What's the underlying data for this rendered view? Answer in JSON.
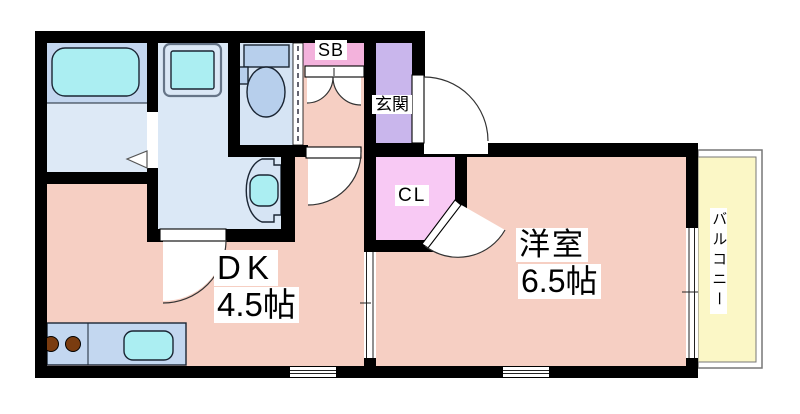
{
  "floorplan": {
    "rooms": {
      "dk": {
        "name": "DK",
        "size": "4.5帖"
      },
      "western_room": {
        "name": "洋室",
        "size": "6.5帖"
      },
      "entrance": {
        "name": "玄関"
      },
      "closet": {
        "name": "CL"
      },
      "shoe_box": {
        "name": "SB"
      },
      "balcony": {
        "name": "バルコニー"
      }
    },
    "colors": {
      "wall": "#000000",
      "floor_main": "#f6cfc3",
      "floor_bath": "#dde9f6",
      "tub_area": "#c3d6ef",
      "floor_washroom": "#dbe8f6",
      "floor_toilet": "#d6e4f4",
      "genkan": "#c9b6ec",
      "closet": "#f8c9f4",
      "shoebox": "#f3b2dc",
      "balcony": "#fbf7c6",
      "counter": "#c3d7f0",
      "fixture": "#b7cfec",
      "water": "#abeef2",
      "burner": "#7a3c10",
      "outline": "#1a2533",
      "door_line": "#333333"
    }
  }
}
